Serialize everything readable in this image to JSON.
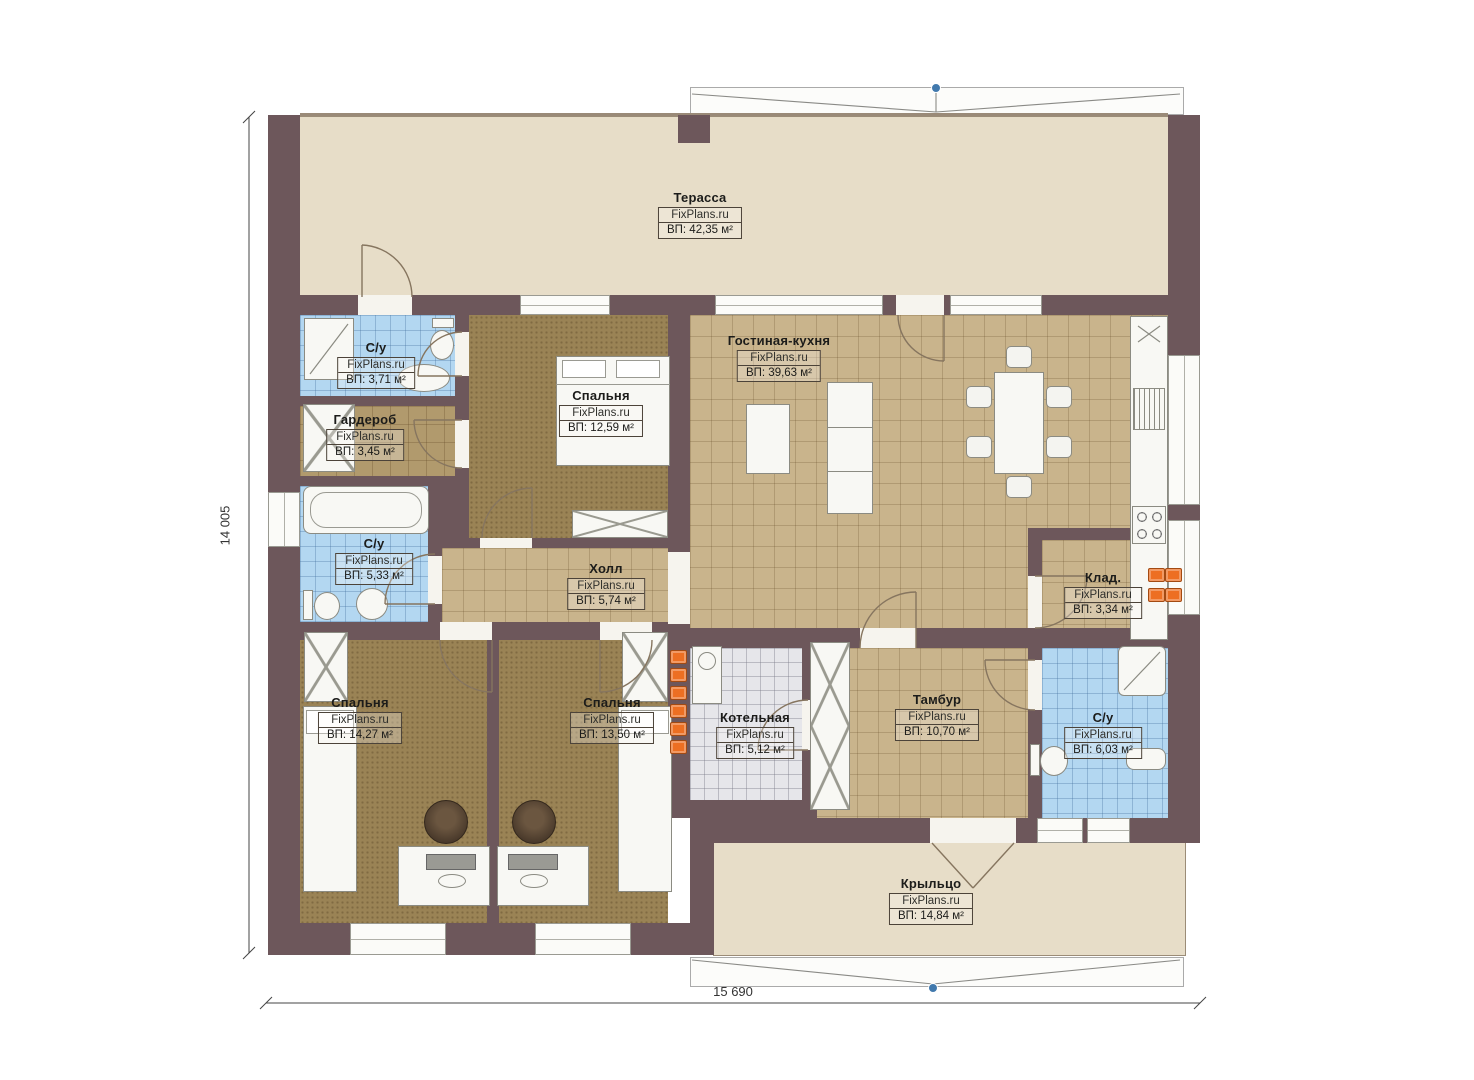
{
  "plan": {
    "brand": "FixPlans.ru",
    "dimensions": {
      "height": "14 005",
      "width": "15 690"
    },
    "rooms": [
      {
        "key": "terrace",
        "title": "Терасса",
        "area": "ВП: 42,35 м²"
      },
      {
        "key": "wc-top",
        "title": "С/у",
        "area": "ВП: 3,71 м²"
      },
      {
        "key": "wardrobe",
        "title": "Гардероб",
        "area": "ВП: 3,45 м²"
      },
      {
        "key": "bedroom-top",
        "title": "Спальня",
        "area": "ВП: 12,59 м²"
      },
      {
        "key": "living-kitchen",
        "title": "Гостиная-кухня",
        "area": "ВП: 39,63 м²"
      },
      {
        "key": "wc-mid",
        "title": "С/у",
        "area": "ВП: 5,33 м²"
      },
      {
        "key": "hall",
        "title": "Холл",
        "area": "ВП: 5,74 м²"
      },
      {
        "key": "storage",
        "title": "Клад.",
        "area": "ВП: 3,34 м²"
      },
      {
        "key": "bedroom-left",
        "title": "Спальня",
        "area": "ВП: 14,27 м²"
      },
      {
        "key": "bedroom-mid",
        "title": "Спальня",
        "area": "ВП: 13,50 м²"
      },
      {
        "key": "boiler",
        "title": "Котельная",
        "area": "ВП: 5,12 м²"
      },
      {
        "key": "vestibule",
        "title": "Тамбур",
        "area": "ВП: 10,70 м²"
      },
      {
        "key": "wc-bottom",
        "title": "С/у",
        "area": "ВП: 6,03 м²"
      },
      {
        "key": "porch",
        "title": "Крыльцо",
        "area": "ВП: 14,84 м²"
      }
    ],
    "colors": {
      "wall": "#6d575b",
      "terrace_floor": "#e7ddc8",
      "tile_tan": "#c9b48c",
      "tile_blue": "#b3d7f1",
      "tile_gray": "#e6e6ea",
      "carpet_brown": "#9a8355",
      "accent_orange": "#ed6f22",
      "marker_blue": "#4179ad"
    }
  }
}
